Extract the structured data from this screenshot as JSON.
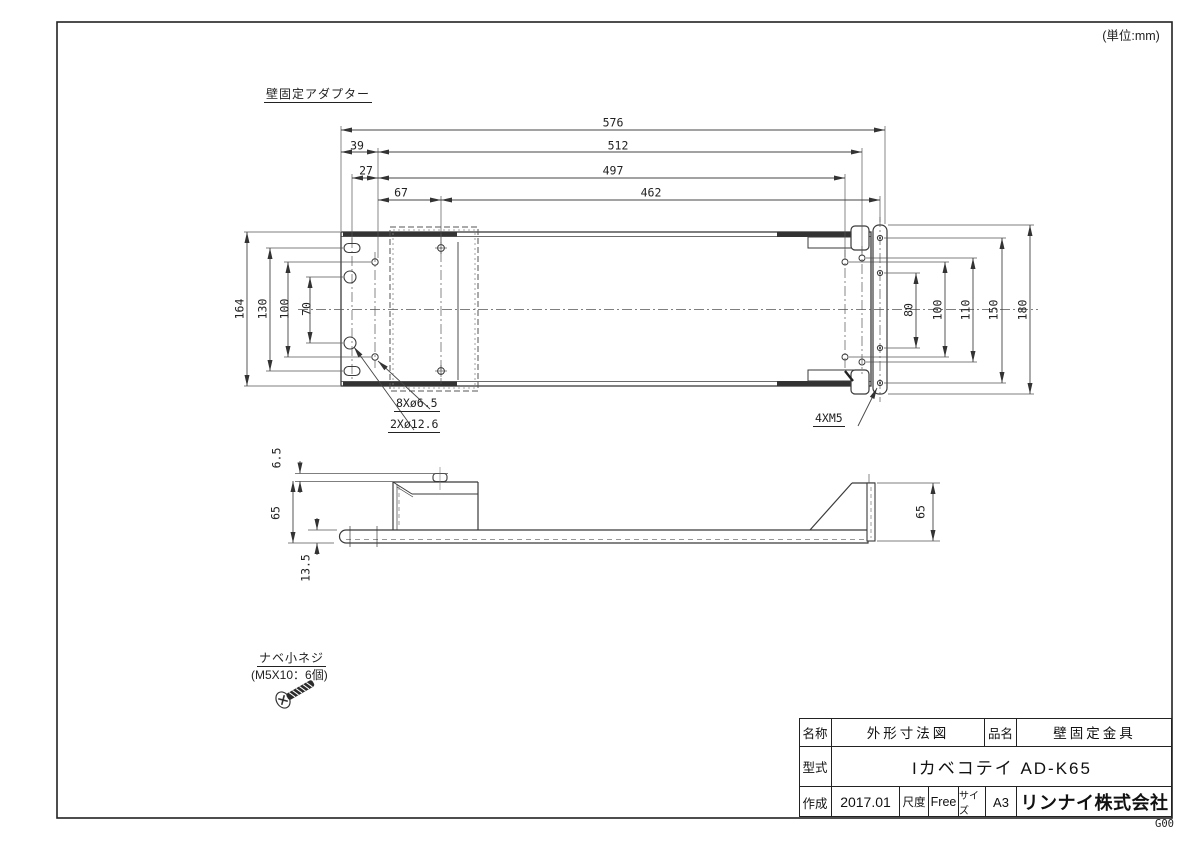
{
  "unit_note": "(単位:mm)",
  "view_title": "壁固定アダプター",
  "dims": {
    "overall_width": "576",
    "edge_39": "39",
    "width_512": "512",
    "offset_27": "27",
    "width_497": "497",
    "offset_67": "67",
    "width_462": "462",
    "height_164": "164",
    "height_130": "130",
    "height_100_left": "100",
    "height_70": "70",
    "height_80": "80",
    "height_100_right": "100",
    "height_110": "110",
    "height_150": "150",
    "height_180": "180",
    "side_6_5": "6.5",
    "side_65_left": "65",
    "side_13_5": "13.5",
    "side_65_right": "65"
  },
  "hole_labels": {
    "small_holes": "8Xø6.5",
    "large_holes": "2Xø12.6",
    "flange_holes": "4XM5"
  },
  "screw_note": {
    "title": "ナベ小ネジ",
    "spec": "(M5X10：6個)"
  },
  "title_block": {
    "name_label": "名称",
    "name_value": "外形寸法図",
    "item_label": "品名",
    "item_value": "壁固定金具",
    "model_label": "型式",
    "model_value": "Iカベコテイ AD-K65",
    "created_label": "作成",
    "created_value": "2017.01",
    "scale_label": "尺度",
    "scale_value": "Free",
    "size_label": "サイズ",
    "size_value": "A3",
    "company": "リンナイ株式会社"
  },
  "sheet_code": "G00"
}
